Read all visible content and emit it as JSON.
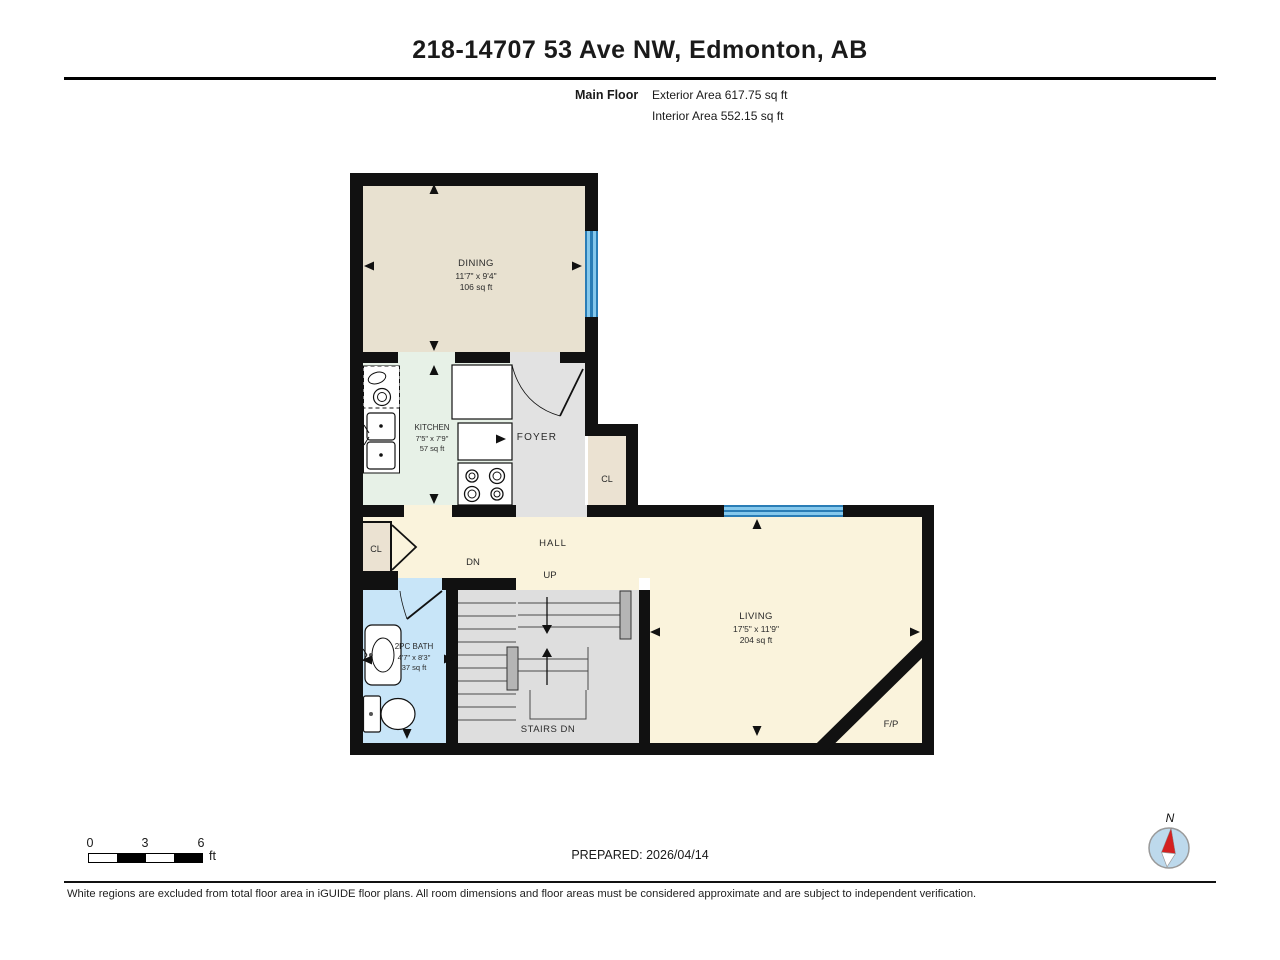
{
  "header": {
    "title": "218-14707 53 Ave NW, Edmonton, AB",
    "floor_label": "Main Floor",
    "exterior_area": "Exterior Area 617.75 sq ft",
    "interior_area": "Interior Area 552.15 sq ft"
  },
  "rooms": {
    "dining": {
      "name": "DINING",
      "dims": "11'7\" x 9'4\"",
      "area": "106 sq ft"
    },
    "kitchen": {
      "name": "KITCHEN",
      "dims": "7'5\" x 7'9\"",
      "area": "57 sq ft"
    },
    "foyer": {
      "name": "FOYER"
    },
    "foyer_closet": {
      "name": "CL"
    },
    "hall": {
      "name": "HALL"
    },
    "hall_closet": {
      "name": "CL"
    },
    "living": {
      "name": "LIVING",
      "dims": "17'5\" x 11'9\"",
      "area": "204 sq ft"
    },
    "bath": {
      "name": "2PC BATH",
      "dims": "4'7\" x 8'3\"",
      "area": "37 sq ft"
    },
    "stairs": {
      "label": "STAIRS DN",
      "up_label": "UP",
      "down_label": "DN"
    },
    "fireplace_label": "F/P"
  },
  "scale_bar": {
    "tick0": "0",
    "tick1": "3",
    "tick2": "6",
    "unit": "ft"
  },
  "prepared_label": "PREPARED: 2026/04/14",
  "compass_label": "N",
  "disclaimer": "White regions are excluded from total floor area in iGUIDE floor plans. All room dimensions and floor areas must be considered approximate and are subject to independent verification.",
  "colors": {
    "wall": "#111111",
    "dining": "#e8e1d0",
    "kitchen": "#e7f1e7",
    "foyer": "#e2e2e2",
    "closet": "#ebe2d2",
    "hall_living": "#faf3dc",
    "bath": "#c8e5f8",
    "stairs": "#dedede",
    "window": "#6db8e6",
    "compass_needle": "#d42020"
  }
}
